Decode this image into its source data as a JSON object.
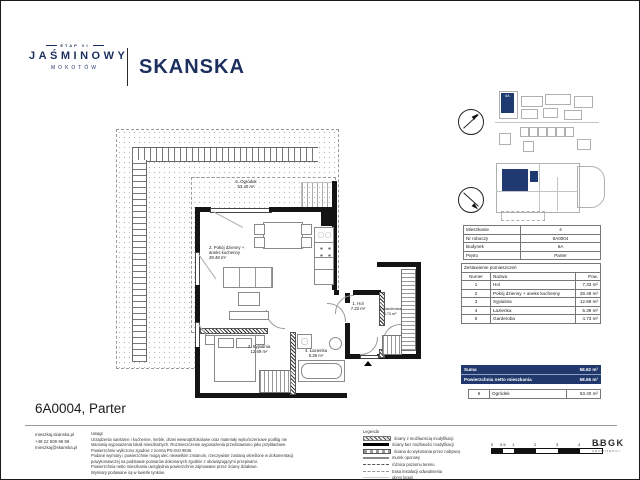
{
  "header": {
    "etap": "ETAP VI",
    "project": "JAŚMINOWY",
    "project_sub": "MOKOTÓW",
    "brand": "SKANSKA"
  },
  "plan": {
    "garden": {
      "name": "6. Ogródek",
      "area": "53.40 m²"
    },
    "living": {
      "line1": "2. Pokój dzienny +",
      "line2": "aneks kuchenny",
      "area": "28.48 m²"
    },
    "hol": {
      "name": "1. Hol",
      "area": "7.33 m²"
    },
    "sypialnia": {
      "name": "3. Sypialnia",
      "area": "12.69 m²"
    },
    "lazienka": {
      "name": "4. Łazienka",
      "area": "5.39 m²"
    },
    "garderoba": {
      "name": "5. Garderoba",
      "area": "4.73 m²"
    }
  },
  "site": {
    "building_label": "6A"
  },
  "info_table": {
    "rows": [
      {
        "label": "Mieszkanie",
        "value": "4"
      },
      {
        "label": "Nr roboczy",
        "value": "6A0004"
      },
      {
        "label": "Budynek",
        "value": "6A"
      },
      {
        "label": "Piętro",
        "value": "Parter"
      }
    ]
  },
  "rooms_table": {
    "title": "Zestawienie pomieszczeń",
    "headers": {
      "num": "Numer",
      "name": "Nazwa",
      "area": "Pow."
    },
    "rows": [
      {
        "num": "1",
        "name": "Hol",
        "area": "7.33 m²"
      },
      {
        "num": "2",
        "name": "Pokój dzienny + aneks kuchenny",
        "area": "28.48 m²"
      },
      {
        "num": "3",
        "name": "Sypialnia",
        "area": "12.69 m²"
      },
      {
        "num": "4",
        "name": "Łazienka",
        "area": "5.39 m²"
      },
      {
        "num": "5",
        "name": "Garderoba",
        "area": "4.73 m²"
      }
    ]
  },
  "summary": {
    "rows": [
      {
        "label": "Suma",
        "value": "58.62 m²"
      },
      {
        "label": "Powierzchnia netto mieszkania",
        "value": "58.55 m²"
      }
    ]
  },
  "garden_row": {
    "num": "6",
    "name": "Ogródek",
    "area": "53.40 m²"
  },
  "footer": {
    "title": "6A0004, Parter",
    "contact": [
      "mieszkaj.skanska.pl",
      "+48 22 509 99 99",
      "mieszkaj@skanska.pl"
    ],
    "uwagi_title": "Uwagi:",
    "uwagi": [
      "Urządzenia sanitarne i kuchenne, meble, drzwi wewnątrzlokalowe oraz materiały wykończeniowe podłóg nie",
      "stanowią wyposażenia lokali mieszkalnych. Rozmieszczenie wyposażenia przedstawiono jako przykładowe.",
      "Powierzchnie wyliczono zgodnie z normą PN-ISO 9836.",
      "Podane wymiary i powierzchnie mogą ulec niewielkim zmianom, rzeczywiste zostaną określone w dokumentacji",
      "powykonawczej na podstawie pomiarów dokonanych zgodnie z obowiązującymi przepisami.",
      "Powierzchnia netto mieszkania uwzględnia powierzchnie zajmowane przez ściany działowe.",
      "Wymiary podawane są w świetle tynków."
    ],
    "legend_title": "Legenda",
    "legend": [
      "ściany z możliwością modyfikacji",
      "ściany bez możliwości modyfikacji",
      "ściana do wykonania przez nabywcę",
      "murek oporowy",
      "różnica poziomu terenu",
      "trasa instalacji odwodnienia",
      "obrys loggii"
    ],
    "scale_labels": [
      "0",
      "0.5",
      "1",
      "2",
      "3",
      "4",
      "5m"
    ],
    "architect": "BBGK",
    "architect_sub": "ARCHITEKCI"
  },
  "colors": {
    "brand_navy": "#1c2f5e",
    "table_navy": "#20386b"
  }
}
